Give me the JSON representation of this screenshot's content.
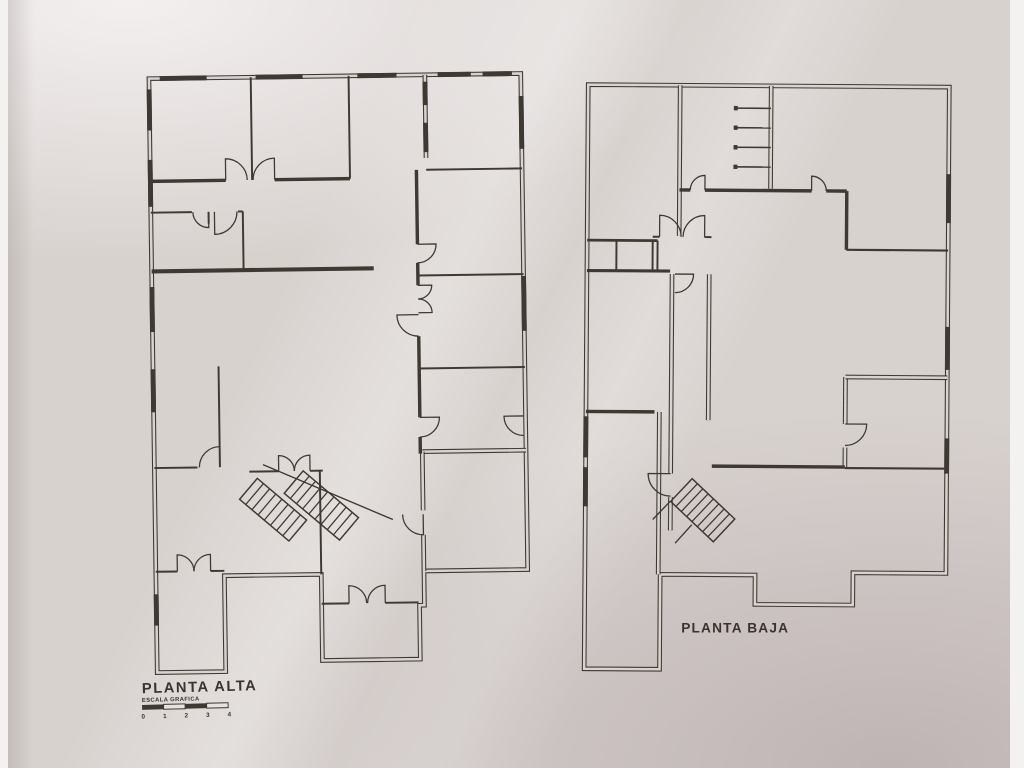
{
  "document": {
    "kind": "scanned architectural floor plan drawing",
    "sheet": "two storey plans"
  },
  "colors": {
    "paper": "#d9d3d0",
    "line": "#3f3933",
    "label": "#3a3430"
  },
  "plans": [
    {
      "id": "plan-planta-alta",
      "label": "PLANTA ALTA",
      "scale_bar": {
        "title": "ESCALA GRAFICA",
        "ticks": [
          "0",
          "1",
          "2",
          "3",
          "4"
        ]
      },
      "offset": [
        141,
        69
      ],
      "rotation": -0.8,
      "outline": [
        [
          3,
          3
        ],
        [
          383,
          3
        ],
        [
          383,
          510
        ],
        [
          277,
          510
        ],
        [
          277,
          545
        ],
        [
          272,
          545
        ],
        [
          272,
          600
        ],
        [
          172,
          600
        ],
        [
          172,
          512
        ],
        [
          73,
          512
        ],
        [
          73,
          610
        ],
        [
          3,
          610
        ]
      ],
      "windows": [
        [
          14,
          3,
          62,
          3
        ],
        [
          112,
          3,
          160,
          3
        ],
        [
          216,
          3,
          256,
          3
        ],
        [
          298,
          3,
          332,
          3
        ],
        [
          344,
          3,
          374,
          3
        ],
        [
          3,
          14,
          3,
          56
        ],
        [
          3,
          86,
          3,
          134
        ],
        [
          3,
          216,
          3,
          262
        ],
        [
          3,
          300,
          3,
          344
        ],
        [
          3,
          530,
          3,
          562
        ],
        [
          383,
          26,
          383,
          80
        ],
        [
          383,
          210,
          383,
          266
        ],
        [
          285,
          10,
          285,
          34
        ],
        [
          285,
          52,
          285,
          82
        ]
      ],
      "double_walls": [
        [
          285,
          3,
          285,
          88
        ],
        [
          277,
          388,
          383,
          388
        ],
        [
          277,
          388,
          277,
          448
        ],
        [
          277,
          473,
          277,
          510
        ]
      ],
      "walls": [
        [
          3,
          108,
          80,
          108,
          3.5
        ],
        [
          130,
          108,
          207,
          108,
          3.5
        ],
        [
          107,
          3,
          107,
          108,
          2
        ],
        [
          207,
          3,
          207,
          108,
          2
        ],
        [
          285,
          100,
          383,
          100,
          2
        ],
        [
          275,
          208,
          383,
          208,
          2
        ],
        [
          275,
          303,
          383,
          303,
          2
        ],
        [
          275,
          100,
          275,
          176,
          3.5
        ],
        [
          275,
          195,
          275,
          218,
          3.5
        ],
        [
          275,
          270,
          275,
          353,
          3.5
        ],
        [
          275,
          373,
          275,
          390,
          3.5
        ],
        [
          3,
          140,
          45,
          140,
          2
        ],
        [
          62,
          140,
          62,
          152,
          2
        ],
        [
          92,
          140,
          97,
          140,
          2
        ],
        [
          97,
          140,
          97,
          200,
          2
        ],
        [
          3,
          200,
          230,
          200,
          4.2
        ],
        [
          70,
          298,
          70,
          401,
          2
        ],
        [
          3,
          401,
          47,
          401,
          2
        ],
        [
          100,
          406,
          130,
          406,
          2
        ],
        [
          162,
          406,
          175,
          406,
          2
        ],
        [
          172,
          406,
          172,
          512,
          2
        ],
        [
          172,
          542,
          200,
          542,
          2
        ],
        [
          237,
          542,
          271,
          542,
          2
        ],
        [
          3,
          507,
          25,
          507,
          2
        ],
        [
          59,
          507,
          73,
          507,
          2
        ]
      ],
      "doors": [
        {
          "h": [
            80,
            108
          ],
          "r": 22,
          "a0": -90,
          "a1": 0
        },
        {
          "h": [
            130,
            108
          ],
          "r": 22,
          "a0": -90,
          "a1": -180
        },
        {
          "h": [
            62,
            140
          ],
          "r": 16,
          "a0": 90,
          "a1": 180
        },
        {
          "h": [
            68,
            140
          ],
          "r": 23,
          "a0": 90,
          "a1": 0
        },
        {
          "h": [
            275,
            176
          ],
          "r": 19,
          "a0": 0,
          "a1": 90
        },
        {
          "h": [
            275,
            218
          ],
          "r": 14,
          "a0": 0,
          "a1": 90
        },
        {
          "h": [
            275,
            246
          ],
          "r": 14,
          "a0": 0,
          "a1": -90
        },
        {
          "h": [
            275,
            248
          ],
          "r": 22,
          "a0": 180,
          "a1": 90
        },
        {
          "h": [
            275,
            353
          ],
          "r": 20,
          "a0": 0,
          "a1": 90
        },
        {
          "h": [
            381,
            353
          ],
          "r": 20,
          "a0": 180,
          "a1": 90
        },
        {
          "h": [
            70,
            401
          ],
          "r": 21,
          "a0": -90,
          "a1": -180
        },
        {
          "h": [
            130,
            406
          ],
          "r": 16,
          "a0": -90,
          "a1": 0
        },
        {
          "h": [
            162,
            406
          ],
          "r": 16,
          "a0": -90,
          "a1": -180
        },
        {
          "h": [
            277,
            452
          ],
          "r": 21,
          "a0": 90,
          "a1": 180
        },
        {
          "h": [
            25,
            507
          ],
          "r": 17,
          "a0": -90,
          "a1": 0
        },
        {
          "h": [
            59,
            507
          ],
          "r": 17,
          "a0": -90,
          "a1": -180
        },
        {
          "h": [
            200,
            542
          ],
          "r": 18,
          "a0": -90,
          "a1": 0
        },
        {
          "h": [
            237,
            542
          ],
          "r": 18,
          "a0": -90,
          "a1": -180
        }
      ],
      "stairs": [
        {
          "x": 108,
          "y": 413,
          "angle": 41,
          "len": 66,
          "wid": 28,
          "steps": 8
        },
        {
          "x": 155,
          "y": 406,
          "angle": 41,
          "len": 74,
          "wid": 30,
          "steps": 9
        }
      ],
      "rails": [
        [
          114,
          399,
          246,
          457
        ]
      ]
    },
    {
      "id": "plan-planta-baja",
      "label": "PLANTA BAJA",
      "offset": [
        590,
        75
      ],
      "rotation": 0.4,
      "outline": [
        [
          3,
          3
        ],
        [
          372,
          3
        ],
        [
          372,
          500
        ],
        [
          277,
          500
        ],
        [
          277,
          533
        ],
        [
          177,
          533
        ],
        [
          177,
          503
        ],
        [
          80,
          503
        ],
        [
          80,
          600
        ],
        [
          3,
          600
        ]
      ],
      "windows": [
        [
          372,
          92,
          372,
          142
        ],
        [
          372,
          248,
          372,
          292
        ],
        [
          372,
          362,
          372,
          398
        ],
        [
          3,
          342,
          3,
          384
        ],
        [
          3,
          394,
          3,
          434
        ]
      ],
      "double_walls": [
        [
          97,
          3,
          97,
          157
        ],
        [
          190,
          3,
          190,
          108
        ],
        [
          90,
          196,
          90,
          400
        ],
        [
          90,
          424,
          90,
          458
        ],
        [
          128,
          196,
          128,
          345
        ],
        [
          78,
          337,
          78,
          503
        ],
        [
          268,
          300,
          268,
          348
        ],
        [
          268,
          372,
          268,
          393
        ],
        [
          268,
          300,
          372,
          300
        ]
      ],
      "walls": [
        [
          97,
          110,
          108,
          110,
          3.5
        ],
        [
          123,
          110,
          232,
          110,
          3.5
        ],
        [
          247,
          110,
          268,
          110,
          3.5
        ],
        [
          268,
          110,
          268,
          170,
          3.5
        ],
        [
          268,
          170,
          372,
          170,
          2.2
        ],
        [
          3,
          162,
          75,
          162,
          2.8
        ],
        [
          3,
          193,
          88,
          193,
          3.2
        ],
        [
          33,
          162,
          33,
          193,
          2
        ],
        [
          70,
          162,
          70,
          193,
          2
        ],
        [
          75,
          162,
          75,
          193,
          2
        ],
        [
          70,
          158,
          77,
          158,
          2
        ],
        [
          123,
          158,
          130,
          158,
          2
        ],
        [
          132,
          392,
          268,
          392,
          3.5
        ],
        [
          268,
          393,
          372,
          393,
          2.2
        ],
        [
          3,
          337,
          73,
          337,
          3.5
        ]
      ],
      "doors": [
        {
          "h": [
            123,
            110
          ],
          "r": 15,
          "a0": -90,
          "a1": -180
        },
        {
          "h": [
            232,
            110
          ],
          "r": 15,
          "a0": -90,
          "a1": 0
        },
        {
          "h": [
            77,
            158
          ],
          "r": 22,
          "a0": -90,
          "a1": 0
        },
        {
          "h": [
            123,
            158
          ],
          "r": 22,
          "a0": -90,
          "a1": -180
        },
        {
          "h": [
            93,
            196
          ],
          "r": 19,
          "a0": 0,
          "a1": 90
        },
        {
          "h": [
            90,
            400
          ],
          "r": 23,
          "a0": 180,
          "a1": 90
        },
        {
          "h": [
            268,
            348
          ],
          "r": 22,
          "a0": 0,
          "a1": 90
        }
      ],
      "stairs": [
        {
          "x": 112,
          "y": 405,
          "angle": 43,
          "len": 60,
          "wid": 32,
          "steps": 8
        }
      ],
      "rails": [
        [
          90,
          428,
          72,
          447
        ],
        [
          112,
          452,
          95,
          471
        ]
      ],
      "ladder": {
        "x1": 152,
        "x2": 190,
        "ys": [
          26,
          46,
          66,
          86
        ]
      }
    }
  ]
}
